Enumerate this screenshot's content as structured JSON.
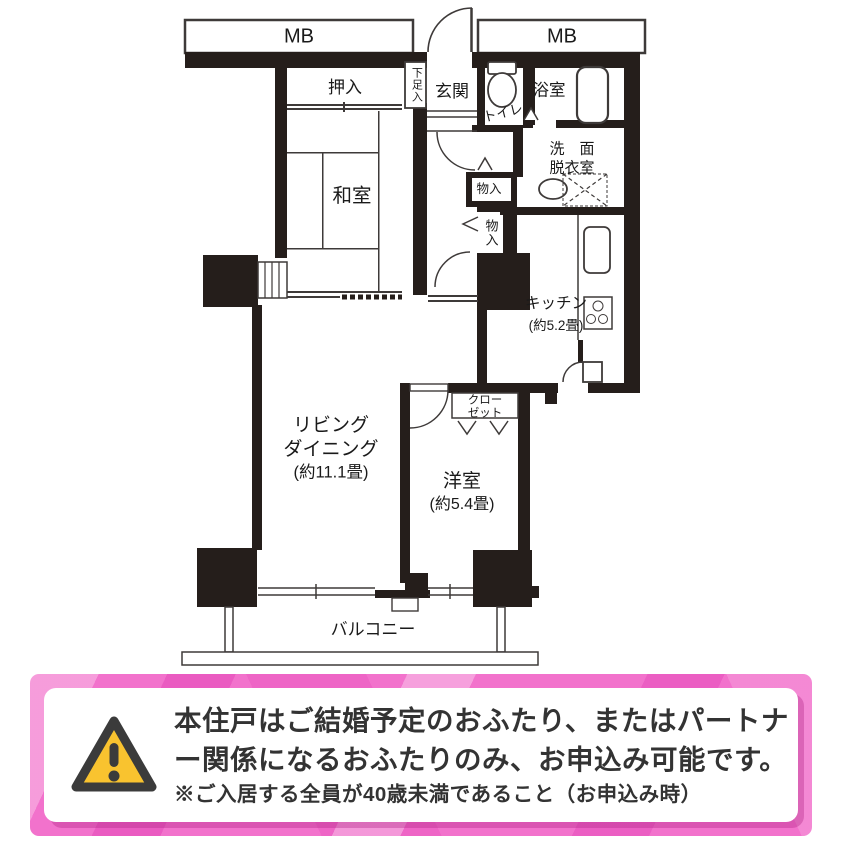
{
  "plan": {
    "mb_left": "MB",
    "mb_right": "MB",
    "rooms": {
      "oshiire": "押入",
      "shoe_box": "下足入",
      "genkan": "玄関",
      "toilet": "トイレ",
      "bath": "浴室",
      "washroom_line1": "洗　面",
      "washroom_line2": "脱衣室",
      "washitsu": "和室",
      "storage_1": "物入",
      "storage_2": "物入",
      "kitchen": "キッチン",
      "kitchen_size": "(約5.2畳)",
      "living_line1": "リビング",
      "living_line2": "ダイニング",
      "living_size": "(約11.1畳)",
      "closet_line1": "クロー",
      "closet_line2": "ゼット",
      "western": "洋室",
      "western_size": "(約5.4畳)",
      "balcony": "バルコニー"
    }
  },
  "notice": {
    "line1": "本住戸はご結婚予定のおふたり、またはパートナ",
    "line2": "ー関係になるおふたりのみ、お申込み可能です。",
    "line3": "※ご入居する全員が40歳未満であること（お申込み時）"
  },
  "colors": {
    "wall": "#251e1b",
    "line": "#3e3a39",
    "pink_frame": "#f272cc",
    "warning_yellow": "#f9c32f",
    "warning_border": "#3b3b3b",
    "notice_text": "#333333"
  }
}
